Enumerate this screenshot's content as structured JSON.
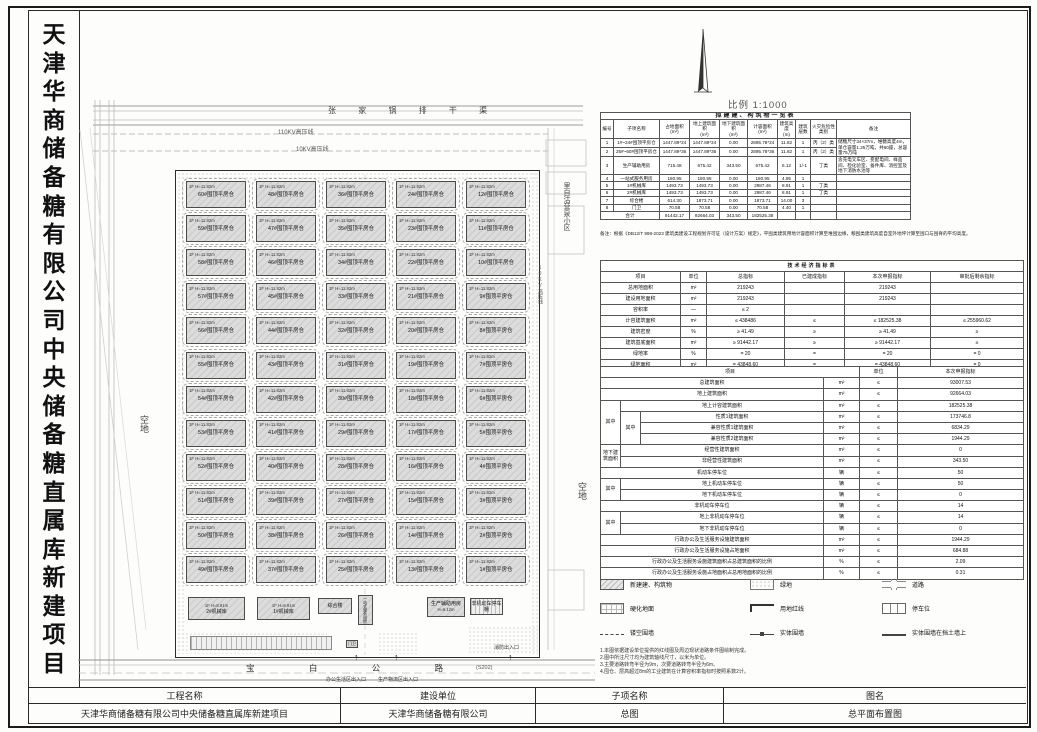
{
  "sheet": {
    "left_title": "天津华商储备糖有限公司中央储备糖直属库新建项目",
    "scale_label": "比例 1:1000",
    "title_block": {
      "headers": [
        "工程名称",
        "建设单位",
        "子项名称",
        "图名"
      ],
      "values": [
        "天津华商储备糖有限公司中央储备糖直属库新建项目",
        "天津华商储备糖有限公司",
        "总图",
        "总平面布置图"
      ]
    }
  },
  "plan": {
    "canal": "张 家 锅 排 干 渠",
    "power_110kv": "110KV高压线",
    "power_10kv": "10KV高压线",
    "power_10kv_right": "10KV高压线",
    "open_left": "空地",
    "open_right": "空地",
    "village_right": "里自沽营泉小区",
    "road": {
      "name_spaced": "宝  白  公  路",
      "code": "(S202)"
    },
    "entrances": {
      "office": "办公生活区出入口",
      "logistics": "生产物流区出入口",
      "fire": "消防出入口"
    },
    "warehouse": {
      "floor_label": "1F H=11.82m",
      "suffix": "#囤顶平房仓",
      "grid": [
        [
          60,
          48,
          36,
          24,
          12
        ],
        [
          59,
          47,
          35,
          23,
          11
        ],
        [
          58,
          46,
          34,
          22,
          10
        ],
        [
          57,
          45,
          33,
          21,
          9
        ],
        [
          56,
          44,
          32,
          20,
          8
        ],
        [
          55,
          43,
          31,
          19,
          7
        ],
        [
          54,
          42,
          30,
          18,
          6
        ],
        [
          53,
          41,
          29,
          17,
          5
        ],
        [
          52,
          40,
          28,
          16,
          4
        ],
        [
          51,
          39,
          27,
          15,
          3
        ],
        [
          50,
          38,
          26,
          14,
          2
        ],
        [
          49,
          37,
          25,
          13,
          1
        ]
      ]
    },
    "aux": {
      "m2": {
        "label": "2#机械库",
        "sub": "1F H=8.91m"
      },
      "m1": {
        "label": "1#机械库",
        "sub": "1F H=8.91m"
      },
      "complex": {
        "label": "综合楼",
        "sub": "3F H=14.00m"
      },
      "oneStop": {
        "label": "一站式服务用房"
      },
      "prodAux": {
        "label": "生产辅助用房",
        "sub": "H=6.12m"
      },
      "bikeShed": {
        "label": "非机动车停车棚"
      },
      "gate": {
        "label": "门卫"
      }
    }
  },
  "building_table": {
    "title": "拟建建、构筑物一览表",
    "headers": [
      "编号",
      "子项名称",
      "占地面积\n(m²)",
      "地上建筑面积\n(m²)",
      "地下建筑面积\n(m²)",
      "计容面积\n(m²)",
      "建筑高度\n(m)",
      "建筑层数",
      "火灾危险性类别",
      "备注"
    ],
    "rows": [
      [
        "1",
        "1#~24#囤顶平房仓",
        "1447.89*24",
        "1447.89*24",
        "0.00",
        "2895.78*24",
        "11.82",
        "1",
        "丙（2）类",
        {
          "t": "储糖尺寸34×37m，堆糖高度4m，单仓容量1.25万吨，共60座，总容量75万吨",
          "rs": 2,
          "cls": "left"
        }
      ],
      [
        "2",
        "25#~60#囤顶平房仓",
        "1447.89*36",
        "1447.89*36",
        "0.00",
        "2895.78*36",
        "11.82",
        "1",
        "丙（2）类"
      ],
      [
        "3",
        "生产辅助用房",
        "715.48",
        "675.42",
        "343.50",
        "675.42",
        "6.12",
        "1/-1",
        "丁类",
        {
          "t": "含充电叉车区、变配电间、样品间、检化验室、备件库、消控室及地下消防水池等",
          "cls": "left"
        }
      ],
      [
        "4",
        "一站式服务用房",
        "180.95",
        "180.95",
        "0.00",
        "180.95",
        "4.95",
        "1",
        "",
        ""
      ],
      [
        "5",
        "1#机械库",
        "1493.73",
        "1493.73",
        "0.00",
        "2987.46",
        "8.91",
        "1",
        "丁类",
        ""
      ],
      [
        "6",
        "2#机械库",
        "1493.73",
        "1493.73",
        "0.00",
        "2987.46",
        "8.91",
        "1",
        "丁类",
        ""
      ],
      [
        "7",
        "综合楼",
        "614.30",
        "1873.71",
        "0.00",
        "1873.71",
        "14.00",
        "3",
        "",
        ""
      ],
      [
        "8",
        "门卫",
        "70.58",
        "70.58",
        "0.00",
        "70.58",
        "4.40",
        "1",
        "",
        ""
      ],
      [
        {
          "t": "合计",
          "cs": 2
        },
        "91442.17",
        "92664.03",
        "343.50",
        "182525.38",
        "",
        "",
        "",
        ""
      ]
    ],
    "note": "备注：根据《DB12/T 998-2023 建筑类建设工程规划许可证（设计方案）规定》，平囤类建筑用地计容面积计算至堆囤边缘，粮囤类建筑高度自室外地坪计算至囤口与囤脊的平均高度。"
  },
  "indicator_table": {
    "title": "技术经济指标表",
    "headers": [
      "项目",
      "单位",
      "总指标",
      "已建成指标",
      "本次申报指标",
      "审批后剩余指标"
    ],
    "rows": [
      [
        "总用地面积",
        "m²",
        "219243",
        "",
        "219243",
        ""
      ],
      [
        "建设用地面积",
        "m²",
        "219243",
        "",
        "219243",
        ""
      ],
      [
        "容积率",
        "—",
        "≤ 2",
        "",
        "",
        ""
      ],
      [
        "计容建筑面积",
        "m²",
        "≤ 438486",
        "≤",
        "≤ 182525.38",
        "≤ 255960.62"
      ],
      [
        "建筑密度",
        "%",
        "≥ 41.49",
        "≥",
        "≥ 41.49",
        "≥"
      ],
      [
        "建筑基底面积",
        "m²",
        "≥ 91442.17",
        "≥",
        "≥ 91442.17",
        "≥"
      ],
      [
        "绿地率",
        "%",
        "= 20",
        "=",
        "= 20",
        "= 0"
      ],
      [
        "绿地面积",
        "m²",
        "= 43848.60",
        "=",
        "= 43848.60",
        "= 0"
      ]
    ]
  },
  "declare_table": {
    "headers": [
      "项目",
      "单位",
      "本次申报指标"
    ],
    "rows": [
      [
        {
          "t": "总建筑面积",
          "cs": 3
        },
        "m²",
        "≤",
        "93007.53"
      ],
      [
        {
          "t": "地上建筑面积",
          "cs": 3
        },
        "m²",
        "≤",
        "92664.03"
      ],
      [
        {
          "t": "其中",
          "rs": 4
        },
        {
          "t": "地上计容建筑面积",
          "cs": 2
        },
        "m²",
        "≤",
        "182525.38"
      ],
      [
        {
          "t": "其中",
          "rs": 3
        },
        "性质1建筑面积",
        "m²",
        "≤",
        "173746.8"
      ],
      [
        "兼容性质1建筑面积",
        "m²",
        "≤",
        "6834.29"
      ],
      [
        "兼容性质2建筑面积",
        "m²",
        "≤",
        "1944.29"
      ],
      [
        {
          "t": "地下建筑面积",
          "rs": 2
        },
        {
          "t": "经营性建筑面积",
          "cs": 2
        },
        "m²",
        "≤",
        "0"
      ],
      [
        {
          "t": "非经营性建筑面积",
          "cs": 2
        },
        "m²",
        "≤",
        "343.50"
      ],
      [
        {
          "t": "机动车停车位",
          "cs": 3
        },
        "辆",
        "≤",
        "50"
      ],
      [
        {
          "t": "其中",
          "rs": 2
        },
        {
          "t": "地上机动车停车位",
          "cs": 2
        },
        "辆",
        "≤",
        "50"
      ],
      [
        {
          "t": "地下机动车停车位",
          "cs": 2
        },
        "辆",
        "≤",
        "0"
      ],
      [
        {
          "t": "非机动车停车位",
          "cs": 3
        },
        "辆",
        "≤",
        "14"
      ],
      [
        {
          "t": "其中",
          "rs": 2
        },
        {
          "t": "地上非机动车停车位",
          "cs": 2
        },
        "辆",
        "≤",
        "14"
      ],
      [
        {
          "t": "地下非机动车停车位",
          "cs": 2
        },
        "辆",
        "≤",
        "0"
      ],
      [
        {
          "t": "行政办公及生活服务设施建筑面积",
          "cs": 3
        },
        "m²",
        "≤",
        "1944.29"
      ],
      [
        {
          "t": "行政办公及生活服务设施占地面积",
          "cs": 3
        },
        "m²",
        "≤",
        "684.88"
      ],
      [
        {
          "t": "行政办公及生活服务设施建筑面积占总建筑面积的比例",
          "cs": 3
        },
        "%",
        "≤",
        "2.09"
      ],
      [
        {
          "t": "行政办公及生活服务设施占地面积占总用地面积的比例",
          "cs": 3
        },
        "%",
        "≤",
        "0.31"
      ]
    ]
  },
  "legend": {
    "items": [
      {
        "key": "hatch",
        "label": "新建建、构筑物"
      },
      {
        "key": "dots",
        "label": "绿地"
      },
      {
        "key": "road",
        "label": "道路"
      },
      {
        "key": "grid",
        "label": "硬化地面"
      },
      {
        "key": "redline",
        "label": "用地红线"
      },
      {
        "key": "parking",
        "label": "停车位"
      },
      {
        "key": "fence",
        "label": "镂空围墙"
      },
      {
        "key": "wall",
        "label": "实体围墙"
      },
      {
        "key": "wall2",
        "label": "实体围墙在挡土墙上"
      }
    ]
  },
  "notes": [
    "1.本图依据建设单位提供的红线图及周边现状道路条件图绘制完成。",
    "2.图中所注尺寸均为建筑轴线尺寸，以米为单位。",
    "3.主要道路转弯半径为9m，次要道路转弯半径为6m。",
    "4.囤仓、层高超过8m的工业建筑在计算容积率指标时按照系数2计。"
  ]
}
